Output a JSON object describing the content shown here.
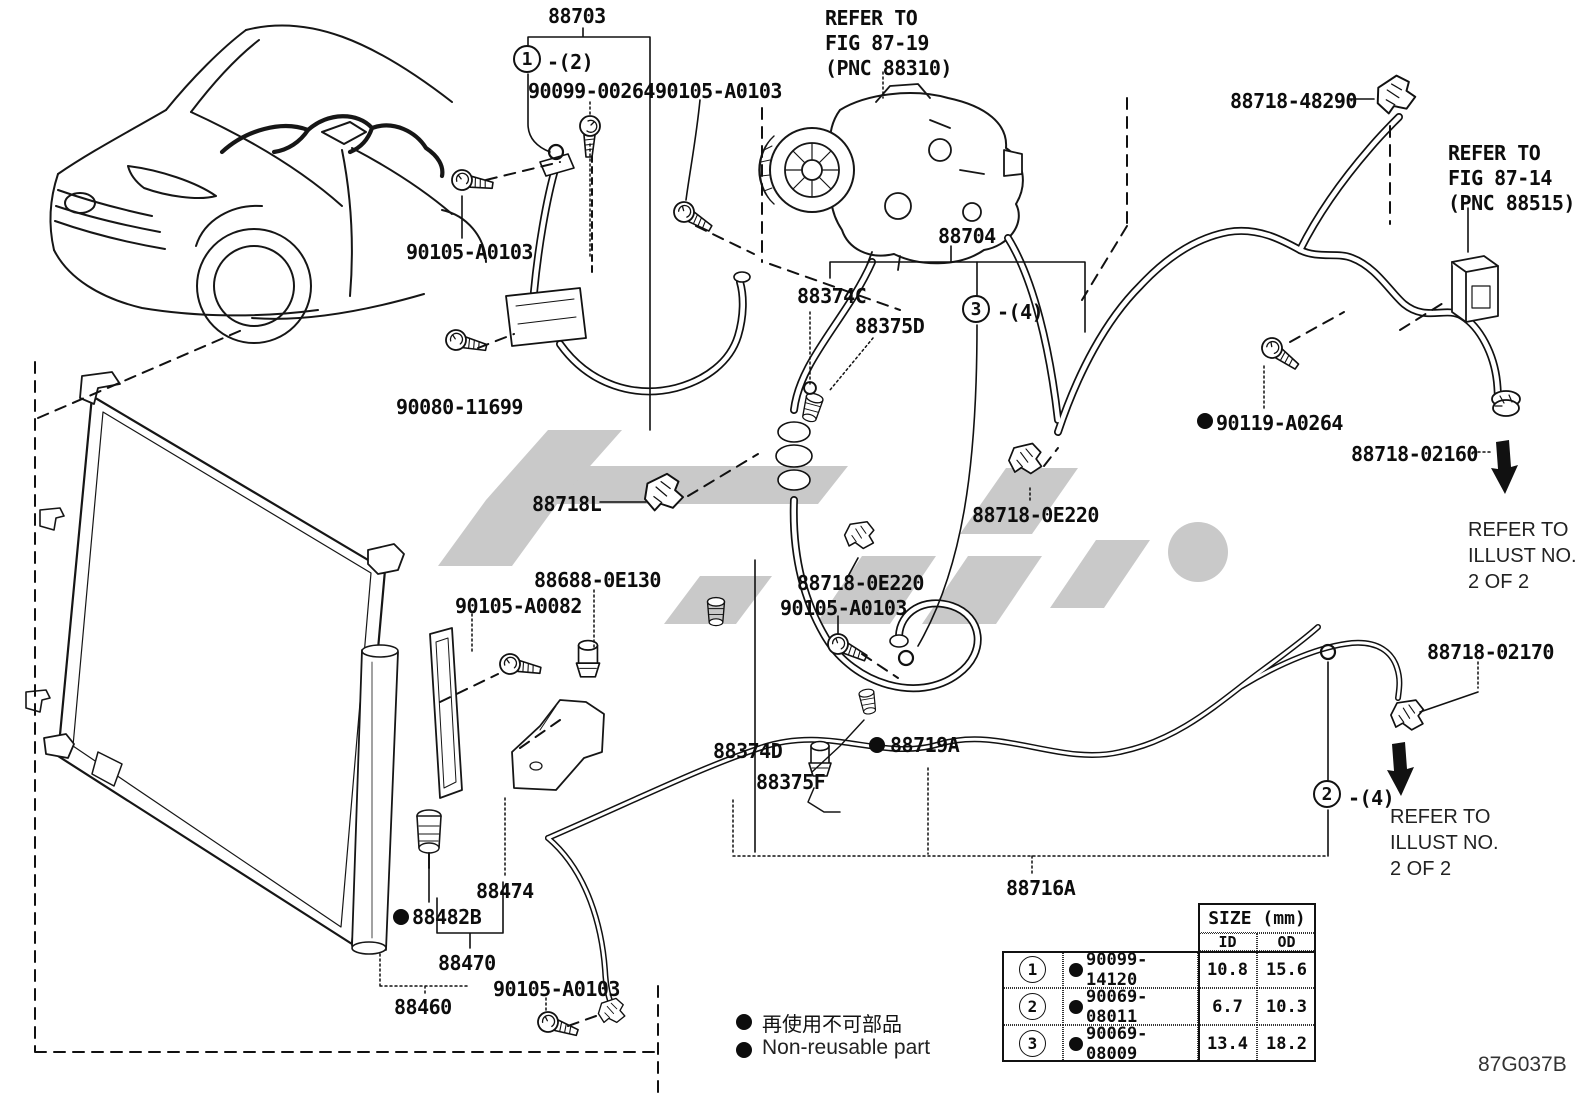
{
  "figure": {
    "code": "87G037B"
  },
  "colors": {
    "ink": "#111111",
    "watermark": "#c9c9c9",
    "background": "#ffffff"
  },
  "legend": {
    "jp": "再使用不可部品",
    "en": "Non-reusable part"
  },
  "callouts": {
    "c1": {
      "num": "1",
      "qty": "-(2)"
    },
    "c2": {
      "num": "2",
      "qty": "-(4)"
    },
    "c3": {
      "num": "3",
      "qty": "-(4)"
    }
  },
  "labels": {
    "l88703": "88703",
    "p90099_00264": "90099-00264",
    "p90105_a0103_top": "90105-A0103",
    "p90105_a0103_left": "90105-A0103",
    "ref_fig8719": "REFER TO\nFIG 87-19\n(PNC 88310)",
    "p88718_48290": "88718-48290",
    "ref_fig8714": "REFER TO\nFIG 87-14\n(PNC 88515)",
    "l88704": "88704",
    "l88374C": "88374C",
    "l88375D": "88375D",
    "p90080_11699": "90080-11699",
    "p90119_a0264": "90119-A0264",
    "p88718_02160": "88718-02160",
    "ref_illust_right": "REFER TO\nILLUST NO.\n2 OF 2",
    "l88718L": "88718L",
    "p88718_0e220_upper": "88718-0E220",
    "p88688_0e130": "88688-0E130",
    "p90105_a0082": "90105-A0082",
    "p88718_0e220_lower": "88718-0E220",
    "p90105_a0103_mid": "90105-A0103",
    "l88374D": "88374D",
    "l88719A": "88719A",
    "l88375F": "88375F",
    "p88718_02170": "88718-02170",
    "ref_illust_lower": "REFER TO\nILLUST NO.\n2 OF 2",
    "l88716A": "88716A",
    "l88474": "88474",
    "l88482B": "88482B",
    "l88470": "88470",
    "l88460": "88460",
    "p90105_a0103_bottom": "90105-A0103"
  },
  "table": {
    "size_header": "SIZE (mm)",
    "id_header": "ID",
    "od_header": "OD",
    "rows": [
      {
        "num": "1",
        "part": "90099-14120",
        "id": "10.8",
        "od": "15.6"
      },
      {
        "num": "2",
        "part": "90069-08011",
        "id": "6.7",
        "od": "10.3"
      },
      {
        "num": "3",
        "part": "90069-08009",
        "id": "13.4",
        "od": "18.2"
      }
    ]
  }
}
